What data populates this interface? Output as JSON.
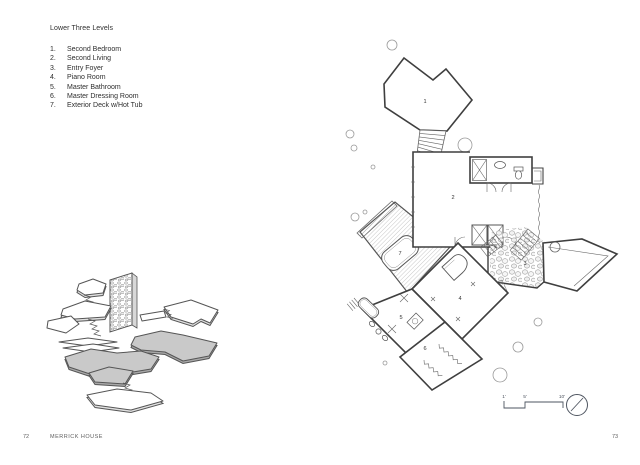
{
  "page": {
    "left_folio": "72",
    "right_folio": "73",
    "footer_title": "MERRICK HOUSE"
  },
  "legend": {
    "title": "Lower Three Levels",
    "items": [
      {
        "num": "1.",
        "label": "Second Bedroom"
      },
      {
        "num": "2.",
        "label": "Second Living"
      },
      {
        "num": "3.",
        "label": "Entry Foyer"
      },
      {
        "num": "4.",
        "label": "Piano Room"
      },
      {
        "num": "5.",
        "label": "Master Bathroom"
      },
      {
        "num": "6.",
        "label": "Master Dressing Room"
      },
      {
        "num": "7.",
        "label": "Exterior Deck w/Hot Tub"
      }
    ]
  },
  "plan": {
    "rooms": [
      "1",
      "2",
      "3",
      "4",
      "5",
      "6",
      "7"
    ],
    "scale_ticks": [
      "1'",
      "5'",
      "10'"
    ],
    "icons": {
      "north_arrow": "north-arrow",
      "trees": "site-tree-circles",
      "stone_floor": "flagstone-texture",
      "deck_hatch": "diagonal-hatch"
    }
  },
  "colors": {
    "ink": "#3f3f3f",
    "light_line": "#9a9a9a",
    "level_shade": "#c9c9c9",
    "paper": "#ffffff",
    "footer_text": "#5f5f5f"
  }
}
